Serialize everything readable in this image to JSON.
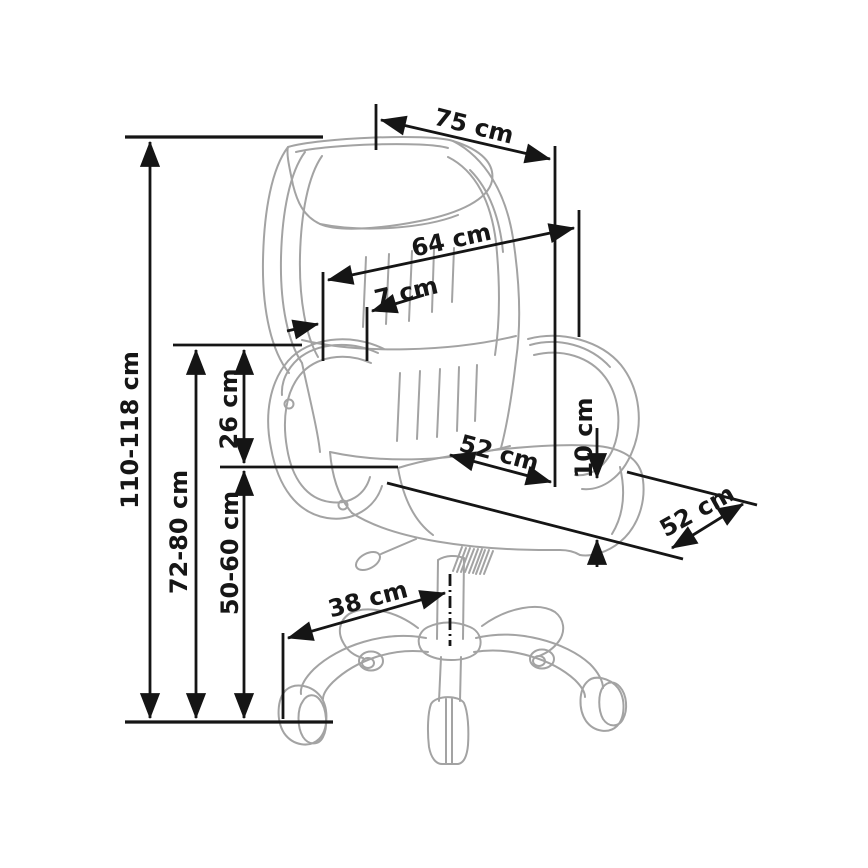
{
  "figure": {
    "kind": "dimensioned-technical-line-drawing",
    "object": "executive swivel office chair",
    "unit": "cm",
    "colors": {
      "background": "#ffffff",
      "drawing_lines": "#a3a3a3",
      "dimension_lines": "#151515",
      "label_text": "#161616"
    }
  },
  "measurements": [
    {
      "id": "overall-height",
      "label": "110-118 cm",
      "min_cm": 110,
      "max_cm": 118,
      "orientation": "vertical"
    },
    {
      "id": "floor-to-armrest",
      "label": "72-80 cm",
      "min_cm": 72,
      "max_cm": 80,
      "orientation": "vertical"
    },
    {
      "id": "seat-to-armrest",
      "label": "26 cm",
      "cm": 26,
      "orientation": "vertical"
    },
    {
      "id": "seat-height",
      "label": "50-60 cm",
      "min_cm": 50,
      "max_cm": 60,
      "orientation": "vertical"
    },
    {
      "id": "overall-width",
      "label": "75 cm",
      "cm": 75,
      "orientation": "diagonal"
    },
    {
      "id": "backrest-width",
      "label": "64 cm",
      "cm": 64,
      "orientation": "diagonal"
    },
    {
      "id": "headrest-offset",
      "label": "7 cm",
      "cm": 7,
      "orientation": "diagonal"
    },
    {
      "id": "seat-width",
      "label": "52 cm",
      "cm": 52,
      "orientation": "diagonal"
    },
    {
      "id": "seat-cushion-thickness",
      "label": "10 cm",
      "cm": 10,
      "orientation": "vertical"
    },
    {
      "id": "seat-depth",
      "label": "52 cm",
      "cm": 52,
      "orientation": "diagonal"
    },
    {
      "id": "base-leg-radius",
      "label": "38 cm",
      "cm": 38,
      "orientation": "diagonal"
    }
  ]
}
